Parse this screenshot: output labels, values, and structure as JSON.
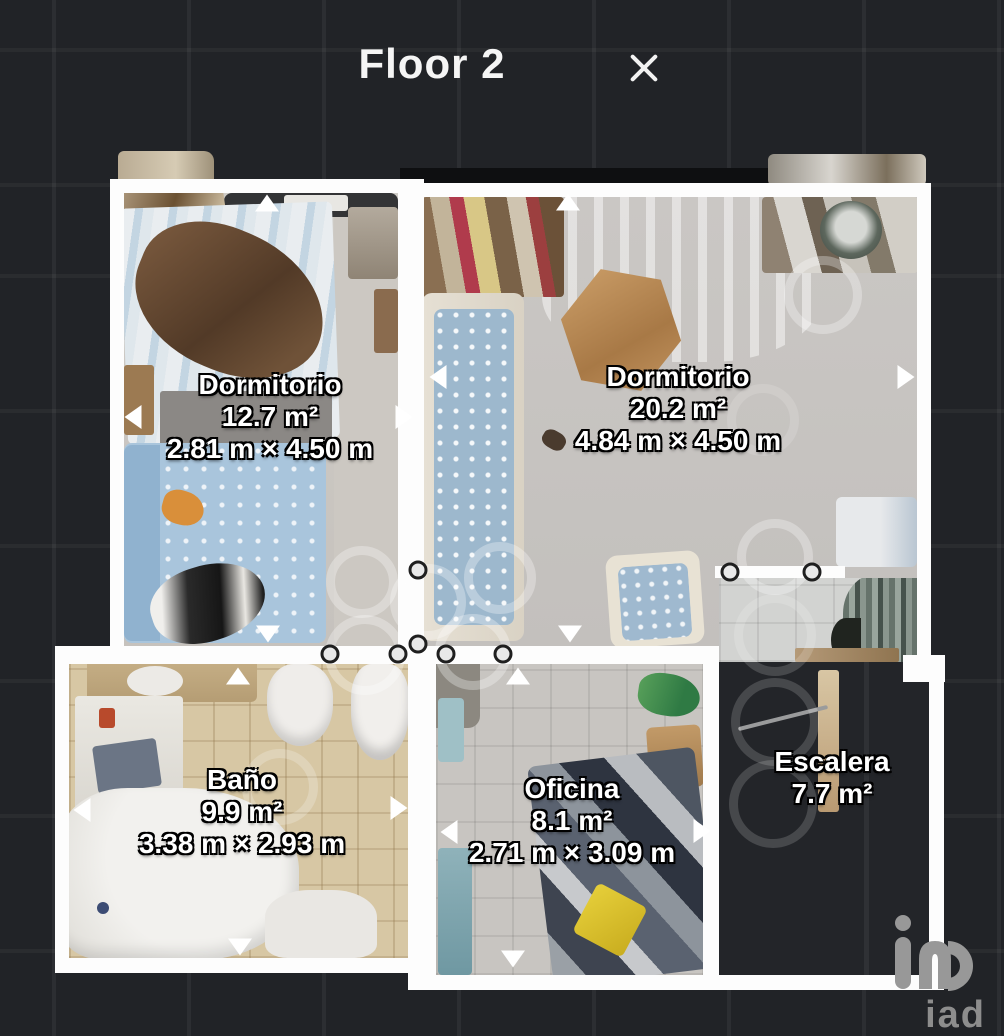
{
  "header": {
    "title": "Floor 2"
  },
  "rooms": [
    {
      "id": "dormitorio-1",
      "name": "Dormitorio",
      "area": "12.7 m²",
      "dimensions": "2.81 m × 4.50 m"
    },
    {
      "id": "dormitorio-2",
      "name": "Dormitorio",
      "area": "20.2 m²",
      "dimensions": "4.84 m × 4.50 m"
    },
    {
      "id": "bano",
      "name": "Baño",
      "area": "9.9 m²",
      "dimensions": "3.38 m × 2.93 m"
    },
    {
      "id": "oficina",
      "name": "Oficina",
      "area": "8.1 m²",
      "dimensions": "2.71 m × 3.09 m"
    },
    {
      "id": "escalera",
      "name": "Escalera",
      "area": "7.7 m²",
      "dimensions": ""
    }
  ],
  "watermark": {
    "text": "iad"
  },
  "colors": {
    "background": "#212327",
    "wall": "#fdfdfd",
    "label_text": "#ffffff",
    "label_outline": "#000000",
    "marker_ring": "rgba(255,255,255,0.30)"
  }
}
